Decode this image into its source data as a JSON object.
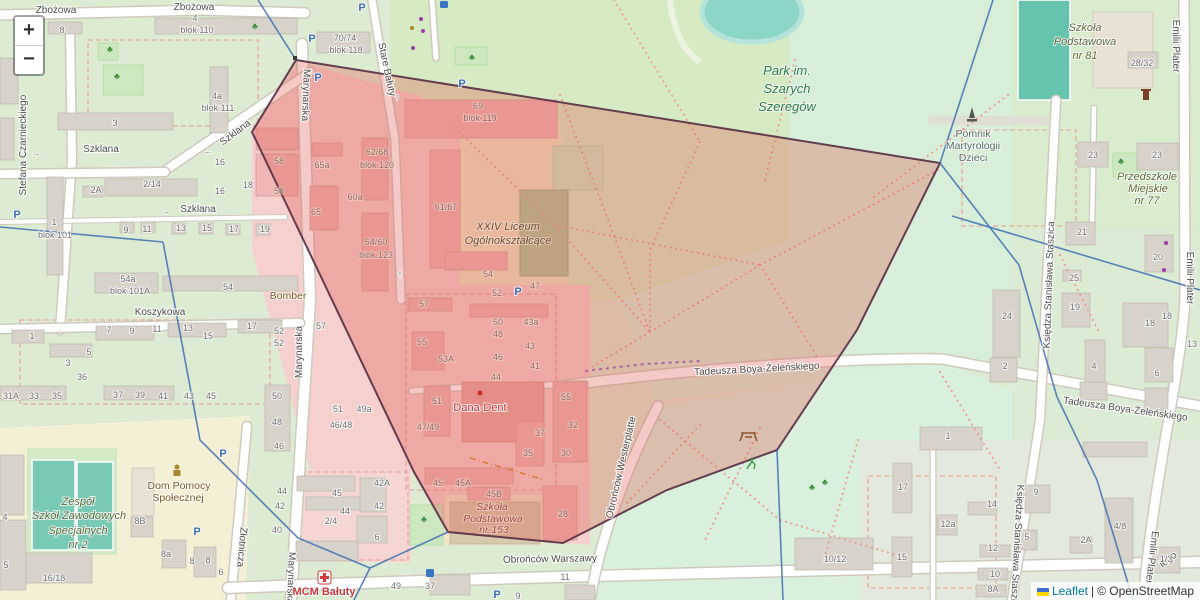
{
  "ui": {
    "zoom_in": "+",
    "zoom_out": "−",
    "attribution": {
      "leaflet": "Leaflet",
      "separator": "|",
      "osm": "© OpenStreetMap"
    }
  },
  "map_labels_format": [
    "class",
    "text",
    "x",
    "y",
    "rotation"
  ],
  "map_labels": [
    [
      "st",
      "Zbożowa",
      56,
      13,
      0
    ],
    [
      "st",
      "Zbożowa",
      194,
      10,
      0
    ],
    [
      "st",
      "Stefana Czarnieckiego",
      26,
      145,
      -90
    ],
    [
      "st",
      "Szklana",
      237,
      135,
      -37
    ],
    [
      "st",
      "Szklana",
      101,
      152,
      0
    ],
    [
      "st",
      "Szklana",
      198,
      212,
      0
    ],
    [
      "st",
      "Marynarska",
      303,
      95,
      92
    ],
    [
      "st",
      "Marynarska",
      302,
      352,
      -90
    ],
    [
      "st",
      "Marynarska",
      288,
      578,
      92
    ],
    [
      "st",
      "Stare Bałuty",
      384,
      70,
      78
    ],
    [
      "st",
      "Koszykowa",
      160,
      315,
      0
    ],
    [
      "st",
      "Złotnicza",
      239,
      547,
      95
    ],
    [
      "st",
      "Obrońców Warszawy",
      550,
      562,
      -1
    ],
    [
      "st",
      "Obrońców Westerplatte",
      624,
      468,
      -77
    ],
    [
      "st",
      "Tadeusza Boya-Żeleńskiego",
      757,
      372,
      -3
    ],
    [
      "st",
      "Tadeusza Boya-Żeleńskiego",
      1125,
      412,
      8
    ],
    [
      "st",
      "Emilii Plater",
      1173,
      46,
      90
    ],
    [
      "st",
      "Emilii Plater",
      1187,
      278,
      90
    ],
    [
      "st",
      "Emilii Plater",
      1149,
      557,
      97
    ],
    [
      "st",
      "Księdza Stanisława Staszica",
      1052,
      285,
      -88
    ],
    [
      "st",
      "Księdza Stanisława Staszica",
      1014,
      548,
      93
    ],
    [
      "st",
      "iego",
      1170,
      562,
      -38
    ],
    [
      "pk",
      "Park im.",
      787,
      75,
      0
    ],
    [
      "pk",
      "Szarych",
      787,
      93,
      0
    ],
    [
      "pk",
      "Szeregów",
      787,
      111,
      0
    ],
    [
      "sc",
      "Szkoła",
      1085,
      31,
      0
    ],
    [
      "sc",
      "Podstawowa",
      1085,
      45,
      0
    ],
    [
      "sc",
      "nr 81",
      1085,
      59,
      0
    ],
    [
      "mo",
      "Pomnik",
      973,
      137,
      0
    ],
    [
      "mo",
      "Martyrologii",
      973,
      149,
      0
    ],
    [
      "mo",
      "Dzieci",
      973,
      161,
      0
    ],
    [
      "sc",
      "Przedszkole",
      1147,
      180,
      0
    ],
    [
      "sc",
      "Miejskie",
      1148,
      192,
      0
    ],
    [
      "sc",
      "nr 77",
      1147,
      204,
      0
    ],
    [
      "scb",
      "XXIV Liceum",
      508,
      230,
      0
    ],
    [
      "scb",
      "Ogólnokształcące",
      508,
      244,
      0
    ],
    [
      "am",
      "Bomber",
      288,
      299,
      0
    ],
    [
      "hp",
      "Dana-Dent",
      480,
      411,
      0
    ],
    [
      "am",
      "Dom Pomocy",
      179,
      489,
      0
    ],
    [
      "am",
      "Społecznej",
      178,
      501,
      0
    ],
    [
      "sc",
      "Zespół",
      78,
      505,
      0
    ],
    [
      "sc",
      "Szkół Zawodowych",
      79,
      519,
      0
    ],
    [
      "sc",
      "Specjalnych",
      78,
      534,
      0
    ],
    [
      "sc",
      "nr 2",
      78,
      548,
      0
    ],
    [
      "mcm",
      "MCM Bałuty",
      324,
      595,
      0
    ],
    [
      "scr",
      "Szkoła",
      492,
      510,
      0
    ],
    [
      "scr",
      "Podstawowa",
      493,
      522,
      0
    ],
    [
      "scr",
      "nr 153",
      494,
      533,
      0
    ],
    [
      "pic",
      "P",
      362,
      11,
      0
    ],
    [
      "pic",
      "P",
      312,
      42,
      0
    ],
    [
      "pic",
      "P",
      318,
      81,
      0
    ],
    [
      "pic",
      "P",
      462,
      87,
      0
    ],
    [
      "pic",
      "P",
      518,
      295,
      0
    ],
    [
      "pic",
      "P",
      223,
      457,
      0
    ],
    [
      "pic",
      "P",
      197,
      535,
      0
    ],
    [
      "pic",
      "P",
      497,
      598,
      0
    ],
    [
      "pic",
      "P",
      17,
      218,
      0
    ],
    [
      "arw",
      "→",
      166,
      214,
      0
    ],
    [
      "arw",
      "→",
      36,
      156,
      0
    ],
    [
      "arw",
      "←",
      208,
      154,
      0
    ],
    [
      "arw",
      "↑",
      397,
      100,
      0
    ],
    [
      "arw",
      "↑",
      400,
      277,
      0
    ],
    [
      "tre",
      "♣",
      110,
      52,
      0
    ],
    [
      "tre",
      "♣",
      117,
      79,
      0
    ],
    [
      "tre",
      "♣",
      255,
      29,
      0
    ],
    [
      "tre",
      "♣",
      472,
      60,
      0
    ],
    [
      "tre",
      "♣",
      424,
      522,
      0
    ],
    [
      "tre",
      "♣",
      825,
      485,
      0
    ],
    [
      "tre",
      "♣",
      1121,
      164,
      0
    ],
    [
      "tre",
      "♣",
      812,
      490,
      0
    ],
    [
      "num",
      "8",
      62,
      33,
      0
    ],
    [
      "num",
      "4",
      195,
      21,
      0
    ],
    [
      "num",
      "blok 110",
      197,
      33,
      0
    ],
    [
      "num",
      "4a",
      217,
      99,
      0
    ],
    [
      "num",
      "blok 111",
      218,
      111,
      0
    ],
    [
      "num",
      "3",
      115,
      126,
      0
    ],
    [
      "num",
      "70/74",
      345,
      41,
      0
    ],
    [
      "num",
      "blok 118",
      346,
      53,
      0
    ],
    [
      "num",
      "2A",
      96,
      193,
      0
    ],
    [
      "num",
      "2/14",
      152,
      187,
      0
    ],
    [
      "num",
      "16",
      220,
      165,
      0
    ],
    [
      "num",
      "16",
      220,
      194,
      0
    ],
    [
      "num",
      "18",
      248,
      188,
      0
    ],
    [
      "num",
      "1",
      54,
      225,
      0
    ],
    [
      "num",
      "blok 101",
      55,
      238,
      0
    ],
    [
      "num",
      "9",
      126,
      233,
      0
    ],
    [
      "num",
      "11",
      147,
      232,
      0
    ],
    [
      "num",
      "13",
      181,
      231,
      0
    ],
    [
      "num",
      "15",
      207,
      231,
      0
    ],
    [
      "num",
      "17",
      234,
      232,
      0
    ],
    [
      "num",
      "19",
      265,
      232,
      0
    ],
    [
      "num",
      "54a",
      128,
      282,
      0
    ],
    [
      "num",
      "blok 101A",
      130,
      294,
      0
    ],
    [
      "num",
      "54",
      228,
      290,
      0
    ],
    [
      "num",
      "1",
      32,
      339,
      0
    ],
    [
      "num",
      "3",
      68,
      366,
      0
    ],
    [
      "num",
      "5",
      89,
      355,
      0
    ],
    [
      "num",
      "7",
      109,
      333,
      0
    ],
    [
      "num",
      "9",
      132,
      334,
      0
    ],
    [
      "num",
      "11",
      157,
      332,
      0
    ],
    [
      "num",
      "13",
      188,
      331,
      0
    ],
    [
      "num",
      "15",
      208,
      339,
      0
    ],
    [
      "num",
      "17",
      252,
      329,
      0
    ],
    [
      "num",
      "52",
      279,
      334,
      0
    ],
    [
      "num",
      "52",
      279,
      346,
      0
    ],
    [
      "num",
      "36",
      82,
      380,
      0
    ],
    [
      "num",
      "31A",
      11,
      399,
      0
    ],
    [
      "num",
      "33",
      34,
      399,
      0
    ],
    [
      "num",
      "35",
      57,
      399,
      0
    ],
    [
      "num",
      "37",
      118,
      398,
      0
    ],
    [
      "num",
      "39",
      140,
      398,
      0
    ],
    [
      "num",
      "41",
      163,
      399,
      0
    ],
    [
      "num",
      "43",
      189,
      399,
      0
    ],
    [
      "num",
      "45",
      211,
      399,
      0
    ],
    [
      "num",
      "50",
      277,
      399,
      0
    ],
    [
      "num",
      "48",
      277,
      425,
      0
    ],
    [
      "num",
      "46",
      279,
      449,
      0
    ],
    [
      "num",
      "16/18",
      54,
      581,
      0
    ],
    [
      "num",
      "8B",
      140,
      524,
      0
    ],
    [
      "num",
      "8a",
      166,
      557,
      0
    ],
    [
      "num",
      "8",
      192,
      564,
      0
    ],
    [
      "num",
      "8",
      208,
      563,
      0
    ],
    [
      "num",
      "6",
      221,
      575,
      0
    ],
    [
      "num",
      "5",
      6,
      568,
      0
    ],
    [
      "num",
      "4",
      5,
      520,
      0
    ],
    [
      "num",
      "44",
      282,
      494,
      0
    ],
    [
      "num",
      "42",
      280,
      509,
      0
    ],
    [
      "num",
      "40",
      277,
      533,
      0
    ],
    [
      "num",
      "45",
      337,
      496,
      0
    ],
    [
      "num",
      "44",
      345,
      514,
      0
    ],
    [
      "num",
      "2/4",
      331,
      524,
      0
    ],
    [
      "num",
      "42A",
      382,
      486,
      0
    ],
    [
      "num",
      "42",
      379,
      509,
      0
    ],
    [
      "num",
      "6",
      377,
      540,
      0
    ],
    [
      "num",
      "49",
      396,
      589,
      0
    ],
    [
      "num",
      "37",
      430,
      589,
      0
    ],
    [
      "num",
      "9",
      518,
      599,
      0
    ],
    [
      "num",
      "11",
      565,
      580,
      0
    ],
    [
      "num",
      "57",
      321,
      329,
      0
    ],
    [
      "num",
      "51",
      338,
      412,
      0
    ],
    [
      "num",
      "49a",
      364,
      412,
      0
    ],
    [
      "num",
      "46/48",
      341,
      428,
      0
    ],
    [
      "num",
      "28/32",
      1142,
      66,
      0
    ],
    [
      "num",
      "23",
      1093,
      158,
      0
    ],
    [
      "num",
      "23",
      1157,
      158,
      0
    ],
    [
      "num",
      "20",
      1158,
      260,
      0
    ],
    [
      "num",
      "21",
      1082,
      235,
      0
    ],
    [
      "num",
      "25",
      1074,
      281,
      0
    ],
    [
      "num",
      "19",
      1075,
      310,
      0
    ],
    [
      "num",
      "24",
      1007,
      319,
      0
    ],
    [
      "num",
      "18",
      1150,
      326,
      0
    ],
    [
      "num",
      "18",
      1167,
      319,
      0
    ],
    [
      "num",
      "13",
      1192,
      347,
      0
    ],
    [
      "num",
      "2",
      1005,
      369,
      0
    ],
    [
      "num",
      "4",
      1094,
      369,
      0
    ],
    [
      "num",
      "6",
      1157,
      376,
      0
    ],
    [
      "num",
      "1",
      948,
      439,
      0
    ],
    [
      "num",
      "9",
      1036,
      495,
      0
    ],
    [
      "num",
      "14",
      992,
      507,
      0
    ],
    [
      "num",
      "12a",
      948,
      527,
      0
    ],
    [
      "num",
      "5",
      1027,
      540,
      0
    ],
    [
      "num",
      "12",
      993,
      551,
      0
    ],
    [
      "num",
      "2A",
      1086,
      543,
      0
    ],
    [
      "num",
      "4/8",
      1120,
      529,
      0
    ],
    [
      "num",
      "10",
      995,
      577,
      0
    ],
    [
      "num",
      "8A",
      993,
      592,
      0
    ],
    [
      "num",
      "1/3",
      1166,
      562,
      0
    ],
    [
      "num",
      "17",
      903,
      490,
      0
    ],
    [
      "num",
      "15",
      902,
      560,
      0
    ],
    [
      "num",
      "10/12",
      835,
      562,
      0
    ],
    [
      "numr",
      "58",
      279,
      164,
      0
    ],
    [
      "numr",
      "58",
      279,
      194,
      0
    ],
    [
      "numr",
      "65a",
      322,
      168,
      0
    ],
    [
      "numr",
      "65",
      316,
      215,
      0
    ],
    [
      "numr",
      "60a",
      355,
      200,
      0
    ],
    [
      "numr",
      "62/68",
      377,
      155,
      0
    ],
    [
      "numr",
      "blok 120",
      377,
      168,
      0
    ],
    [
      "numr",
      "54/60",
      376,
      245,
      0
    ],
    [
      "numr",
      "blok 123",
      376,
      258,
      0
    ],
    [
      "numr",
      "61/67",
      446,
      210,
      0
    ],
    [
      "numr",
      "69",
      478,
      109,
      0
    ],
    [
      "numr",
      "blok 119",
      480,
      121,
      0
    ],
    [
      "numr",
      "54",
      488,
      277,
      0
    ],
    [
      "numr",
      "47",
      535,
      289,
      0
    ],
    [
      "numr",
      "52",
      497,
      296,
      0
    ],
    [
      "numr",
      "57",
      424,
      307,
      0
    ],
    [
      "numr",
      "50",
      498,
      325,
      0
    ],
    [
      "numr",
      "43a",
      531,
      325,
      0
    ],
    [
      "numr",
      "48",
      498,
      337,
      0
    ],
    [
      "numr",
      "43",
      530,
      349,
      0
    ],
    [
      "numr",
      "46",
      498,
      360,
      0
    ],
    [
      "numr",
      "41",
      535,
      369,
      0
    ],
    [
      "numr",
      "44",
      496,
      380,
      0
    ],
    [
      "numr",
      "55",
      422,
      345,
      0
    ],
    [
      "numr",
      "53A",
      446,
      362,
      0
    ],
    [
      "numr",
      "51",
      437,
      404,
      0
    ],
    [
      "numr",
      "47/49",
      428,
      430,
      0
    ],
    [
      "numr",
      "55",
      566,
      400,
      0
    ],
    [
      "numr",
      "32",
      573,
      428,
      0
    ],
    [
      "numr",
      "37",
      540,
      436,
      0
    ],
    [
      "numr",
      "35",
      528,
      456,
      0
    ],
    [
      "numr",
      "30",
      566,
      456,
      0
    ],
    [
      "numr",
      "45",
      438,
      486,
      0
    ],
    [
      "numr",
      "45A",
      463,
      486,
      0
    ],
    [
      "numr",
      "45B",
      494,
      497,
      0
    ],
    [
      "numr",
      "28",
      563,
      517,
      0
    ]
  ]
}
